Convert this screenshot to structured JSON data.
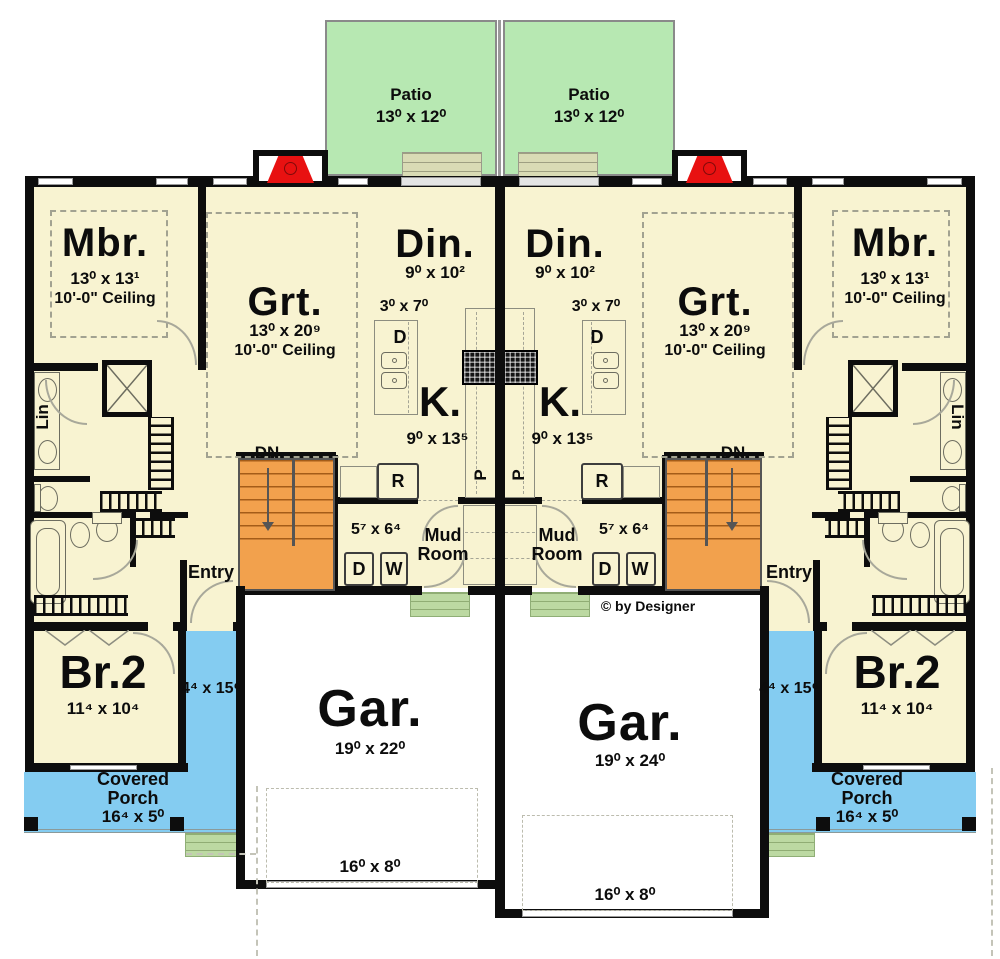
{
  "copyright": "© by Designer",
  "patio": {
    "label": "Patio",
    "dims": "13⁰ x 12⁰"
  },
  "master": {
    "label": "Mbr.",
    "dims": "13⁰ x 13¹",
    "ceiling": "10'-0\" Ceiling"
  },
  "great_room": {
    "label": "Grt.",
    "dims": "13⁰ x 20⁹",
    "ceiling": "10'-0\" Ceiling"
  },
  "dining": {
    "label": "Din.",
    "dims": "9⁰ x 10²"
  },
  "kitchen": {
    "label": "K.",
    "dims": "9⁰ x 13⁵",
    "island_dims": "3⁰ x 7⁰",
    "dishwasher": "D",
    "fridge": "R",
    "pantry": "P"
  },
  "stairs": {
    "label": "DN"
  },
  "mud_room": {
    "label": "Mud Room",
    "dims": "5⁷ x 6⁴",
    "dryer": "D",
    "washer": "W"
  },
  "entry": {
    "label": "Entry"
  },
  "bedroom2": {
    "label": "Br.2",
    "dims": "11⁴ x 10⁴"
  },
  "side_porch": {
    "dims": "4⁴ x 15⁶"
  },
  "covered_porch": {
    "label": "Covered Porch",
    "dims": "16⁴ x 5⁰"
  },
  "garage_left": {
    "label": "Gar.",
    "dims": "19⁰ x 22⁰",
    "door_dims": "16⁰ x 8⁰"
  },
  "garage_right": {
    "label": "Gar.",
    "dims": "19⁰ x 24⁰",
    "door_dims": "16⁰ x 8⁰"
  },
  "linen": {
    "label": "Lin"
  },
  "colors": {
    "floor": "#f8f3d1",
    "patio_green": "#b7e8b2",
    "porch_blue": "#84ccf1",
    "stairs_orange": "#f2a14d",
    "step_green": "#bcd9a2",
    "fireplace_red": "#e81111",
    "wall_black": "#0d0d0d",
    "garage_white": "#ffffff"
  }
}
